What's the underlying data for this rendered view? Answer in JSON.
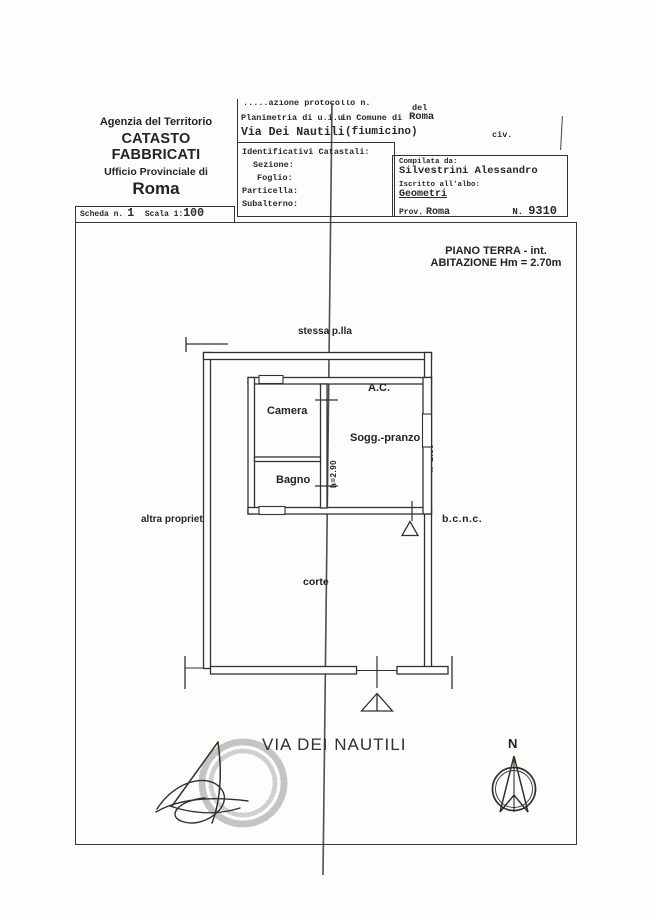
{
  "colors": {
    "ink": "#2f2d2a",
    "paper": "#fdfdfb",
    "faint": "#55524e"
  },
  "agency": {
    "line1": "Agenzia del Territorio",
    "line2": "CATASTO FABBRICATI",
    "line3": "Ufficio Provinciale di",
    "line4": "Roma"
  },
  "protocol": {
    "cut_line": ".....azione protocollo n.",
    "del": "del",
    "planimetria": "Planimetria di u.i.u",
    "comune_label": "in Comune di",
    "comune_value": "Roma",
    "street": "Via Dei Nautili",
    "street_note": "(fiumicino)",
    "civ": "civ."
  },
  "catastali": {
    "title": "Identificativi Catastali:",
    "fields": [
      "Sezione:",
      "Foglio:",
      "Particella:",
      "Subalterno:"
    ]
  },
  "compiler": {
    "label": "Compilata da:",
    "name": "Silvestrini Alessandro",
    "albo_label": "Iscritto all'albo:",
    "albo_value": "Geometri",
    "prov_label": "Prov.",
    "prov_value": "Roma",
    "number_label": "N.",
    "number_value": "9310"
  },
  "scheda": {
    "label": "Scheda n.",
    "number": "1",
    "scala_label": "Scala 1:",
    "scala_value": "100"
  },
  "plan_header": {
    "line1": "PIANO TERRA - int.",
    "line2": "ABITAZIONE Hm = 2.70m"
  },
  "plan_labels": {
    "stessa": "stessa p.lla",
    "camera": "Camera",
    "ac": "A.C.",
    "sogg": "Sogg.-pranzo",
    "bagno": "Bagno",
    "h_left": "h=2.90",
    "h_right": "h=2.80",
    "altra": "altra proprietà",
    "bcnc": "b.c.n.c.",
    "corte": "corte"
  },
  "street_title": "VIA DEI NAUTILI",
  "compass": {
    "label": "N"
  }
}
